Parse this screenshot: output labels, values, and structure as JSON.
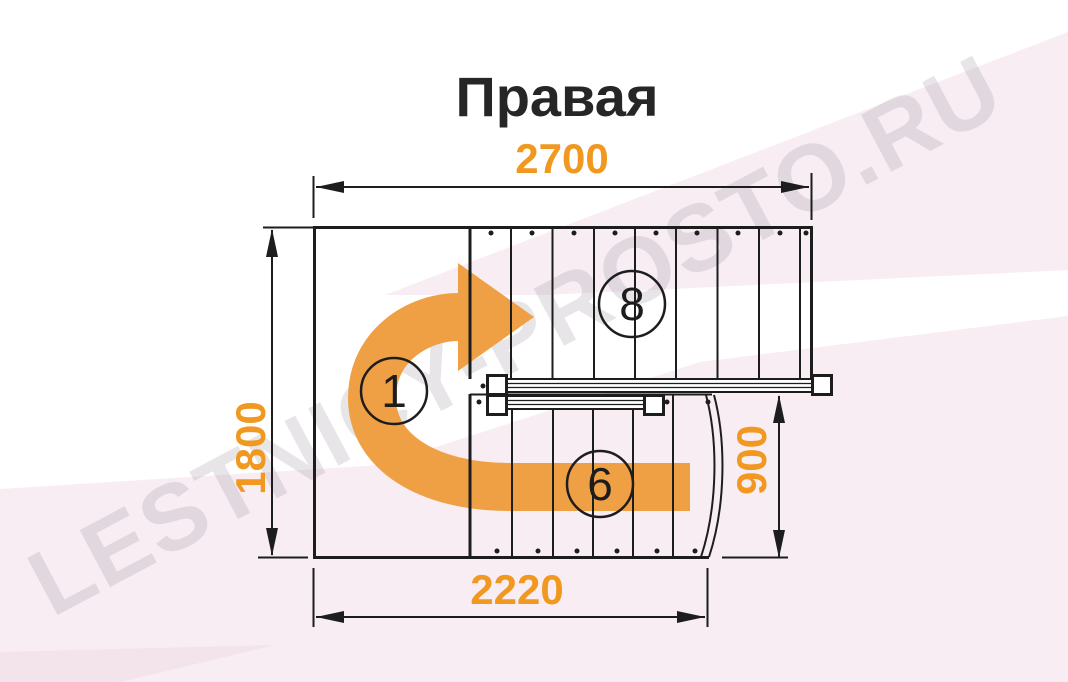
{
  "title": "Правая",
  "watermark": "LESTNICY-PROSTO.RU",
  "dimensions": {
    "top": "2700",
    "left": "1800",
    "bottom": "2220",
    "right": "900"
  },
  "steps": {
    "start": "1",
    "upper": "8",
    "lower": "6"
  },
  "colors": {
    "accent_orange": "#F0981F",
    "arrow_orange": "#F0A044",
    "line_black": "#1D1D1D",
    "pink_band": "#F8EDF3",
    "pink_band_deep": "#F3E3EB",
    "watermark_gray": "#D9D2D8"
  }
}
